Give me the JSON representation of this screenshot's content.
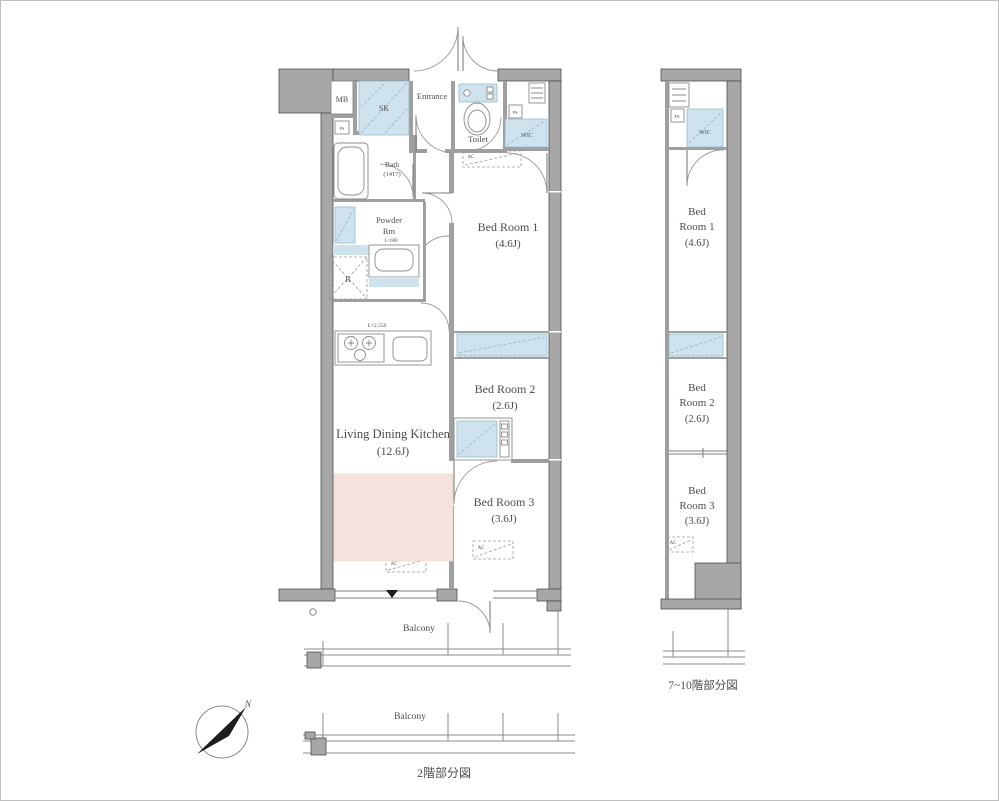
{
  "main_plan": {
    "rooms": {
      "mb": "MB",
      "sk": "SK",
      "entrance": "Entrance",
      "toilet": "Toilet",
      "wic": "WIC",
      "bath_name": "Bath",
      "bath_size": "(1417)",
      "powder_1": "Powder",
      "powder_2": "Rm",
      "bed1": "Bed Room 1",
      "bed1_size": "(4.6J)",
      "bed2": "Bed Room 2",
      "bed2_size": "(2.6J)",
      "bed3": "Bed Room 3",
      "bed3_size": "(3.6J)",
      "ldk": "Living Dining Kitchen",
      "ldk_size": "(12.6J)",
      "balcony": "Balcony"
    },
    "annotations": {
      "refrigerator": "R",
      "air_conditioner": "AC",
      "pipe_space": "PS",
      "kitchen_length": "L=2,550",
      "vanity_length": "L=690"
    }
  },
  "sub_plan": {
    "wic": "WIC",
    "bed1_1": "Bed",
    "bed1_2": "Room 1",
    "bed1_size": "(4.6J)",
    "bed2_1": "Bed",
    "bed2_2": "Room 2",
    "bed2_size": "(2.6J)",
    "bed3_1": "Bed",
    "bed3_2": "Room 3",
    "bed3_size": "(3.6J)",
    "caption": "7~10階部分図"
  },
  "bottom_plan": {
    "balcony": "Balcony",
    "caption": "2階部分図"
  },
  "compass": {
    "label": "N"
  },
  "colors": {
    "wall": "#a7a7a7",
    "wall_stroke": "#4e4e4e",
    "blue_shade": "#cfe3ef",
    "pink_rug": "#f4e3e0",
    "text": "#4d4d4d"
  }
}
